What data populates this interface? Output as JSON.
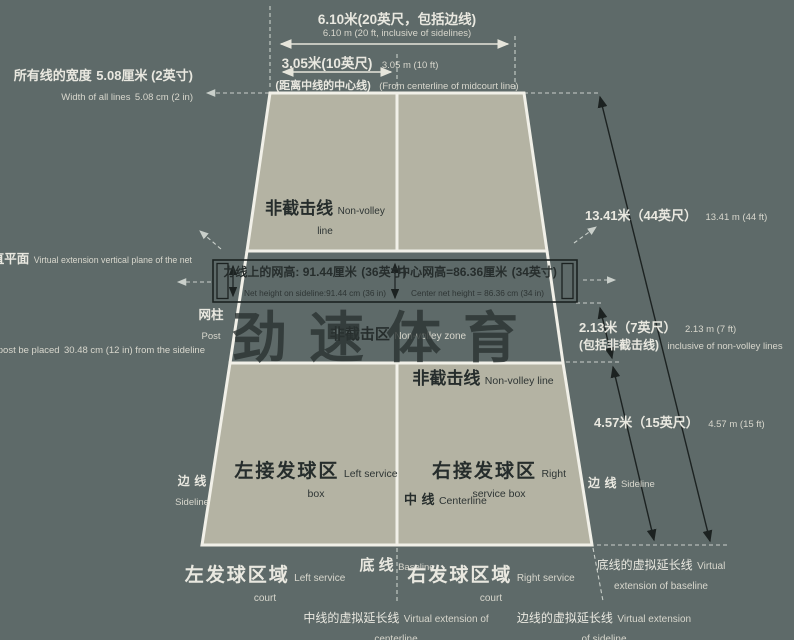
{
  "colors": {
    "background": "#5e6a69",
    "court_fill": "#b4b3a3",
    "line_white": "#f1f0e8",
    "ink_dark": "#262d2c",
    "text_light": "#e9e8e0",
    "arrow_black": "#1c2221",
    "dashed_gray": "#c9cfca",
    "watermark_ink": "#2a3231"
  },
  "watermark": {
    "text": "劲速体育"
  },
  "top": {
    "total_cn": "6.10米(20英尺，包括边线)",
    "total_en": "6.10 m (20 ft, inclusive of sidelines)",
    "half_cn": "3.05米(10英尺)",
    "half_en": "3.05 m (10 ft)",
    "half_note_cn": "(距离中线的中心线)",
    "half_note_en": "(From centerline of midcourt line)"
  },
  "left_side": {
    "line_width_cn1": "所有线的宽度",
    "line_width_cn2": "5.08厘米 (2英寸)",
    "line_width_en1": "Width of all lines",
    "line_width_en2": "5.08 cm (2 in)",
    "net_plane_cn": "球网的虚拟延伸垂直平面",
    "net_plane_en": "Virtual extension vertical plane of the net",
    "post_cn": "网柱",
    "post_en": "Post",
    "post_place_cn1": "建议网柱放置在距离边线",
    "post_place_cn2": "30.48厘米(12英寸)处",
    "post_place_en1": "It is recommended that the net post be placed",
    "post_place_en2": "30.48 cm (12 in) from the sideline",
    "sideline_cn1": "边",
    "sideline_cn2": "线",
    "sideline_en": "Sideline"
  },
  "right_side": {
    "length_cn": "13.41米（44英尺）",
    "length_en": "13.41 m (44 ft)",
    "nvz_cn": "2.13米（7英尺）",
    "nvz_en": "2.13 m (7 ft)",
    "nvz_note_cn": "(包括非截击线)",
    "nvz_note_en": "inclusive of non-volley lines",
    "service_cn": "4.57米（15英尺）",
    "service_en": "4.57 m (15 ft)",
    "sideline_cn1": "边",
    "sideline_cn2": "线",
    "sideline_en": "Sideline"
  },
  "court": {
    "nv_line_top_cn": "非截击线",
    "nv_line_top_en": "Non-volley line",
    "nv_zone_cn": "非截击区",
    "nv_zone_en": "Non-volley zone",
    "nv_line_bottom_cn": "非截击线",
    "nv_line_bottom_en": "Non-volley line",
    "left_box_cn": "左接发球区",
    "left_box_en": "Left service box",
    "right_box_cn": "右接发球区",
    "right_box_en": "Right service box",
    "centerline_cn1": "中",
    "centerline_cn2": "线",
    "centerline_en": "Centerline"
  },
  "net": {
    "sideline_height_cn1": "力线上的网高: 91.44厘米",
    "sideline_height_cn2": "(36英寸)",
    "sideline_height_en": "Net height on sideline:91.44 cm (36 in)",
    "center_height_cn1": "中心网高=86.36厘米",
    "center_height_cn2": "(34英寸)",
    "center_height_en": "Center net height = 86.36 cm (34 in)"
  },
  "bottom": {
    "left_court_cn": "左发球区域",
    "left_court_en": "Left service court",
    "baseline_cn": "底 线",
    "baseline_en": "Baseline",
    "right_court_cn": "右发球区域",
    "right_court_en": "Right service court",
    "centerline_ext_cn": "中线的虚拟延长线",
    "centerline_ext_en": "Virtual extension of centerline",
    "sideline_ext_cn": "边线的虚拟延长线",
    "sideline_ext_en": "Virtual extension of sideline",
    "baseline_ext_cn": "底线的虚拟延长线",
    "baseline_ext_en": "Virtual extension of baseline"
  }
}
